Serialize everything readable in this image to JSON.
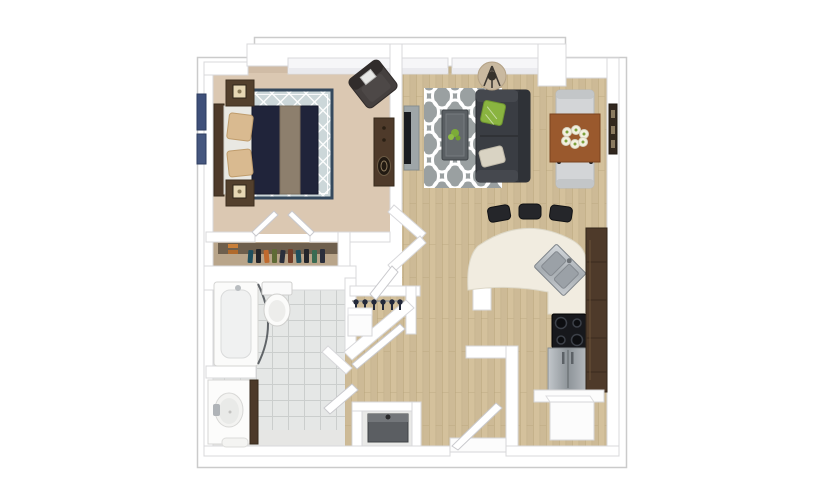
{
  "meta": {
    "description": "Top-down 3D rendered floor plan of a one-bedroom, one-bathroom apartment with open living room, kitchen with curved breakfast bar, entry, and closets",
    "plan_type": "3d-floor-plan",
    "background": "#ffffff"
  },
  "colors": {
    "outline": "#cbcbcb",
    "wall_fill": "#ffffff",
    "wall_edge": "#d8d8db",
    "window_fill": "#f6f6f8",
    "carpet": "#dbc8b2",
    "carpet_shadow": "#c3ae97",
    "wood": "#d4c19c",
    "wood_line": "#b8a57e",
    "tile": "#e5e7e6",
    "tile_line": "#cbcecd",
    "closet_floor": "#b9a58a",
    "closet_shadow": "#6e5f4d",
    "rug_bedroom": "#ccd7d9",
    "rug_border": "#35495d",
    "rug_living": "#9aa0a1",
    "bed_duvet": "#20243a",
    "bed_runner": "#8d7f6d",
    "bed_sheet": "#e9e8e3",
    "pillow_tan": "#d9ba90",
    "wood_dark_furniture": "#4e3a2a",
    "armchair": "#45403f",
    "sofa": "#3a3d43",
    "pillow_green": "#8ab440",
    "pillow_cream": "#d9d3c3",
    "coffee_table": "#5a5f63",
    "lamp_shade": "#c9b9a0",
    "tv": "#1a1c20",
    "tv_stand": "#9fa6a8",
    "dining_table": "#9a592d",
    "chair_gray": "#d3d5d7",
    "counter_cream": "#f1ece0",
    "stool_black": "#25262a",
    "cabinet_brown": "#4e3a2a",
    "cooktop_black": "#17181c",
    "unit_gray": "#5b5e62"
  },
  "rooms": [
    {
      "name": "bedroom",
      "floor": "beige carpet",
      "furniture": [
        "bed with dark duvet and tan pillows",
        "nightstand with lamp (x2)",
        "diamond-lattice area rug",
        "corner accent armchair",
        "tall dresser",
        "leaning wall art"
      ]
    },
    {
      "name": "bedroom-closet",
      "floor": "wood",
      "contents": [
        "hanging clothes on rod",
        "bifold doors"
      ]
    },
    {
      "name": "bathroom",
      "floor": "gray tile",
      "fixtures": [
        "bathtub with curved shower rod",
        "toilet",
        "vanity with oval sink",
        "bath mat"
      ]
    },
    {
      "name": "hall-closet",
      "contents": [
        "hangers on rod",
        "white drawer unit"
      ]
    },
    {
      "name": "utility-closet",
      "contents": [
        "gray mechanical unit"
      ]
    },
    {
      "name": "living-room",
      "floor": "light wood",
      "furniture": [
        "charcoal sofa",
        "green accent pillow",
        "cream accent pillow",
        "quatrefoil rug",
        "coffee table with plant",
        "floor lamp",
        "wall-mounted tv with stand"
      ]
    },
    {
      "name": "dining-area",
      "furniture": [
        "wood dining table",
        "upholstered chair (x2)",
        "flower centerpiece",
        "wall art"
      ]
    },
    {
      "name": "kitchen",
      "furniture": [
        "curved breakfast bar",
        "bar stool (x3)",
        "diagonal corner sink",
        "cooktop",
        "stainless refrigerator",
        "tall brown cabinet run"
      ]
    },
    {
      "name": "entry",
      "furniture": [
        "entry door (open)",
        "storage closet with white unit",
        "shelf"
      ]
    }
  ],
  "counts": {
    "bedrooms": 1,
    "bathrooms": 1,
    "bar_stools": 3,
    "dining_chairs": 2,
    "nightstands": 2
  }
}
